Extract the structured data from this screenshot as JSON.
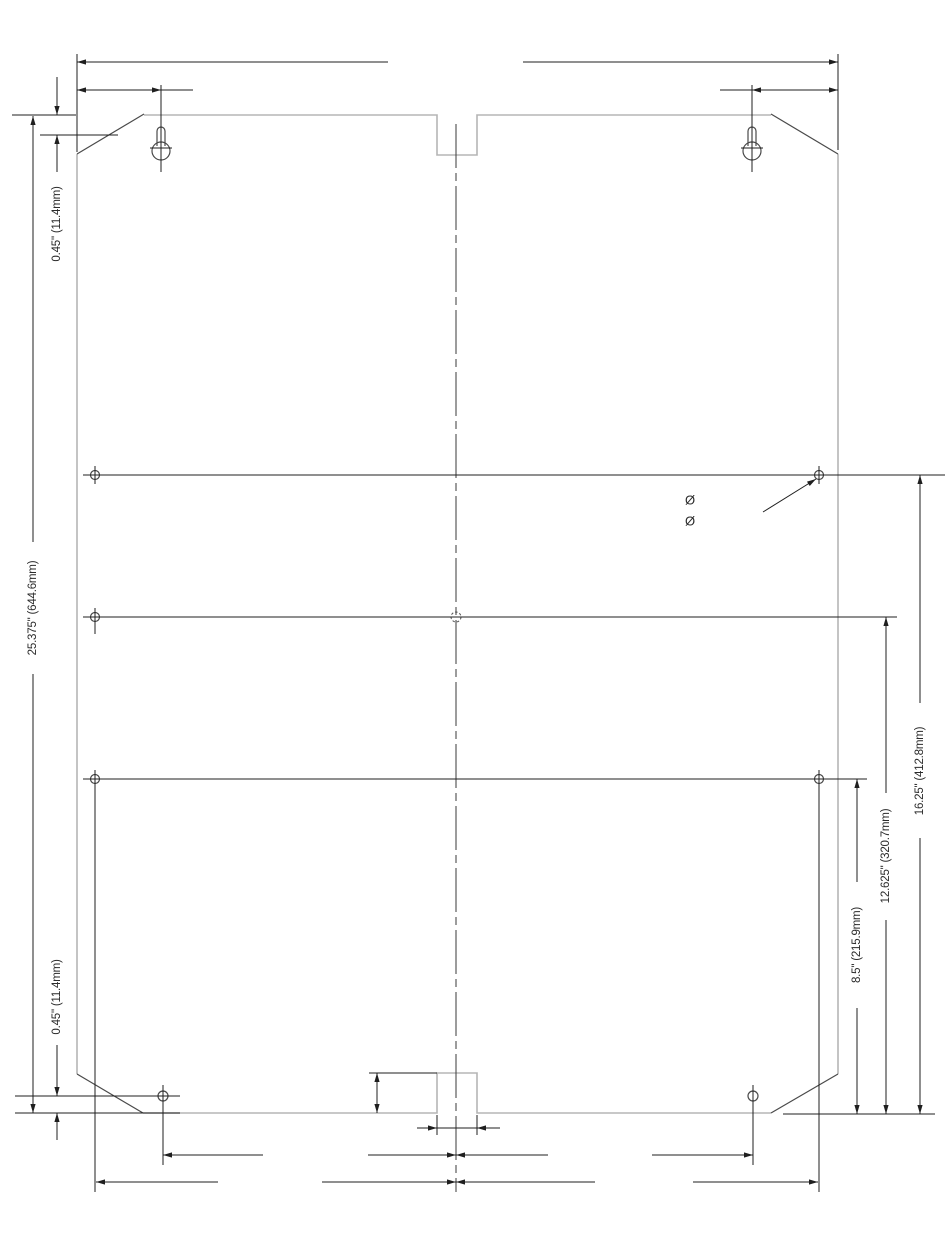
{
  "drawing": {
    "title": "mounting-plate-dimension-drawing",
    "labels": {
      "top_offset": "0.45\" (11.4mm)",
      "overall_height": "25.375\" (644.6mm)",
      "bottom_offset": "0.45\" (11.4mm)",
      "row1_height": "8.5\" (215.9mm)",
      "row2_height": "12.625\" (320.7mm)",
      "row3_height": "16.25\" (412.8mm)",
      "hole_diameter_symbol_1": "Ø",
      "hole_diameter_symbol_2": "Ø"
    },
    "colors": {
      "outline": "#b5b5b5",
      "feature": "#4a4a4a",
      "dimension": "#1f1f1f",
      "text": "#2b2b2b"
    }
  }
}
